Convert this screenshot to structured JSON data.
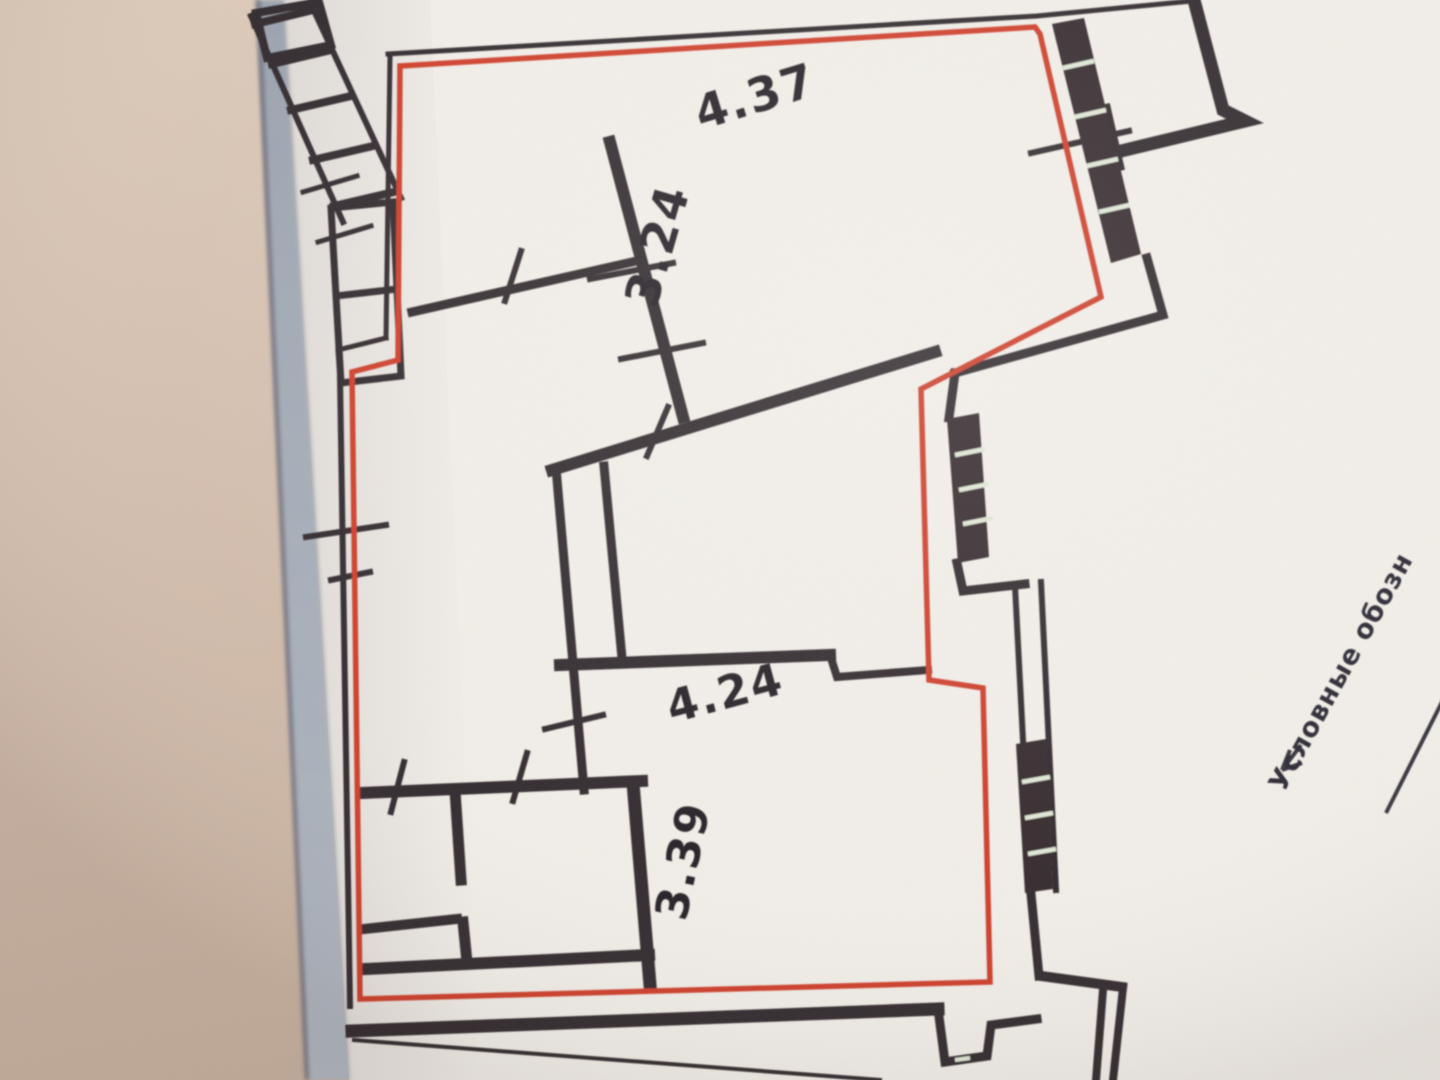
{
  "floorplan": {
    "dimension_labels": {
      "top_width": "4.37",
      "top_height": "3.24",
      "bottom_width": "4.24",
      "bottom_height": "3.39"
    },
    "legend_caption": "Условные обозн",
    "colors": {
      "outline_red": "#cd3a26",
      "ink": "#2f2529",
      "thin_ink": "#3c3236",
      "window_band": "#30262a",
      "window_slit": "#dfe7d5",
      "paper": "#f1ede7",
      "shadow_wedge_top": "#98a1ad",
      "shadow_wedge_bottom": "#aeb5bf",
      "background_top": "#dcc9b8",
      "background_bottom": "#c7b09e",
      "text_ink": "#241d20"
    }
  }
}
